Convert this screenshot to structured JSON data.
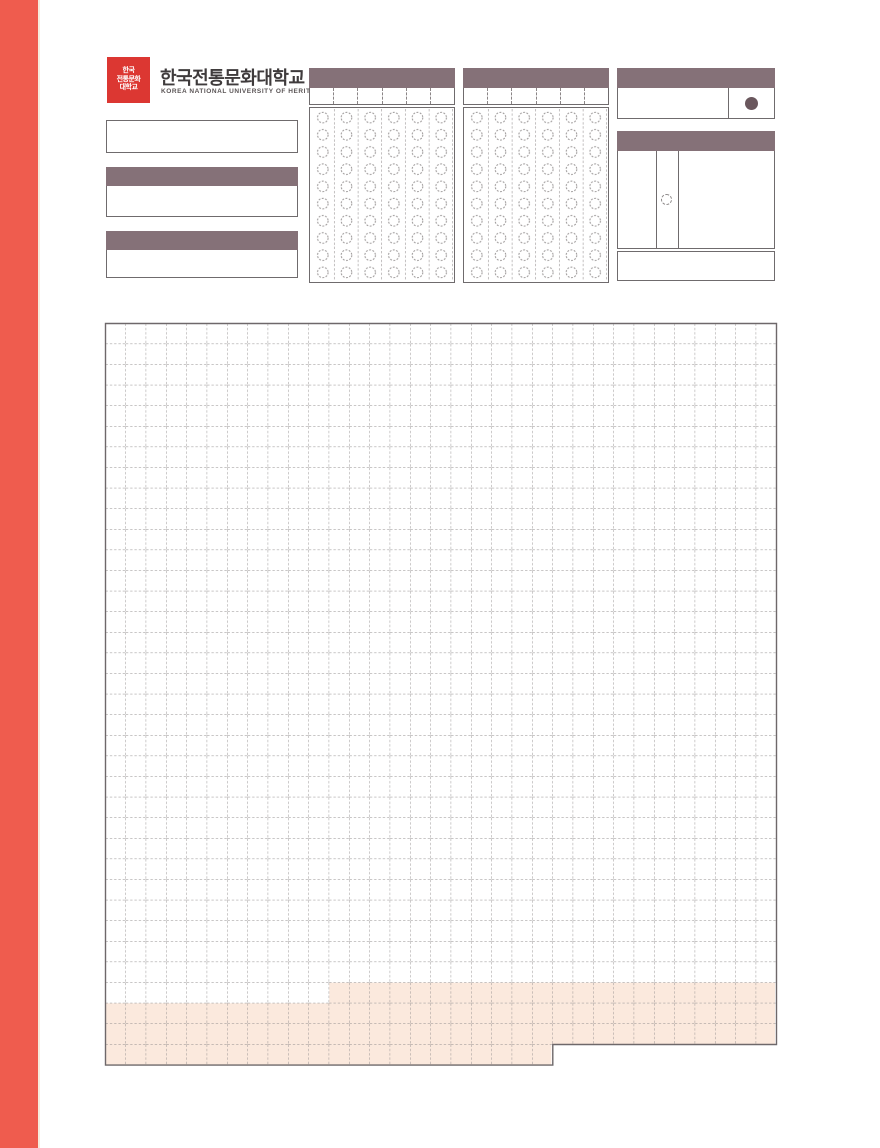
{
  "branding": {
    "title": "한국전통문화대학교",
    "subtitle": "KOREA NATIONAL UNIVERSITY OF HERITAGE",
    "logo_lines": [
      "한국",
      "전통문화",
      "대학교"
    ]
  },
  "colors": {
    "accent_coral": "#ef5c4e",
    "header_mauve": "#857178",
    "logo_red": "#dc3732",
    "highlight_peach": "#fbe9dd",
    "marked_dot": "#6a575d",
    "border_gray": "#6f6b6d",
    "grid_line": "#8f8b8b",
    "bubble_line": "#989494"
  },
  "left_panels": {
    "count": 3,
    "note": "blank entry boxes with solid header bars, no printed text visible"
  },
  "omr_blocks": {
    "count": 2,
    "digit_cells": 6,
    "bubble_columns": 6,
    "bubble_rows": 10
  },
  "marker_box": {
    "filled_dot": true
  },
  "detail_box": {
    "columns": 3,
    "confirmation_bubble": true
  },
  "answer_grid": {
    "columns": 33,
    "rows": 35,
    "extra_bottom_row_columns": 22,
    "highlight": {
      "partial_row_index": 32,
      "partial_row_start_column": 11,
      "full_rows": [
        33,
        34
      ],
      "extra_row_highlighted": true
    }
  }
}
